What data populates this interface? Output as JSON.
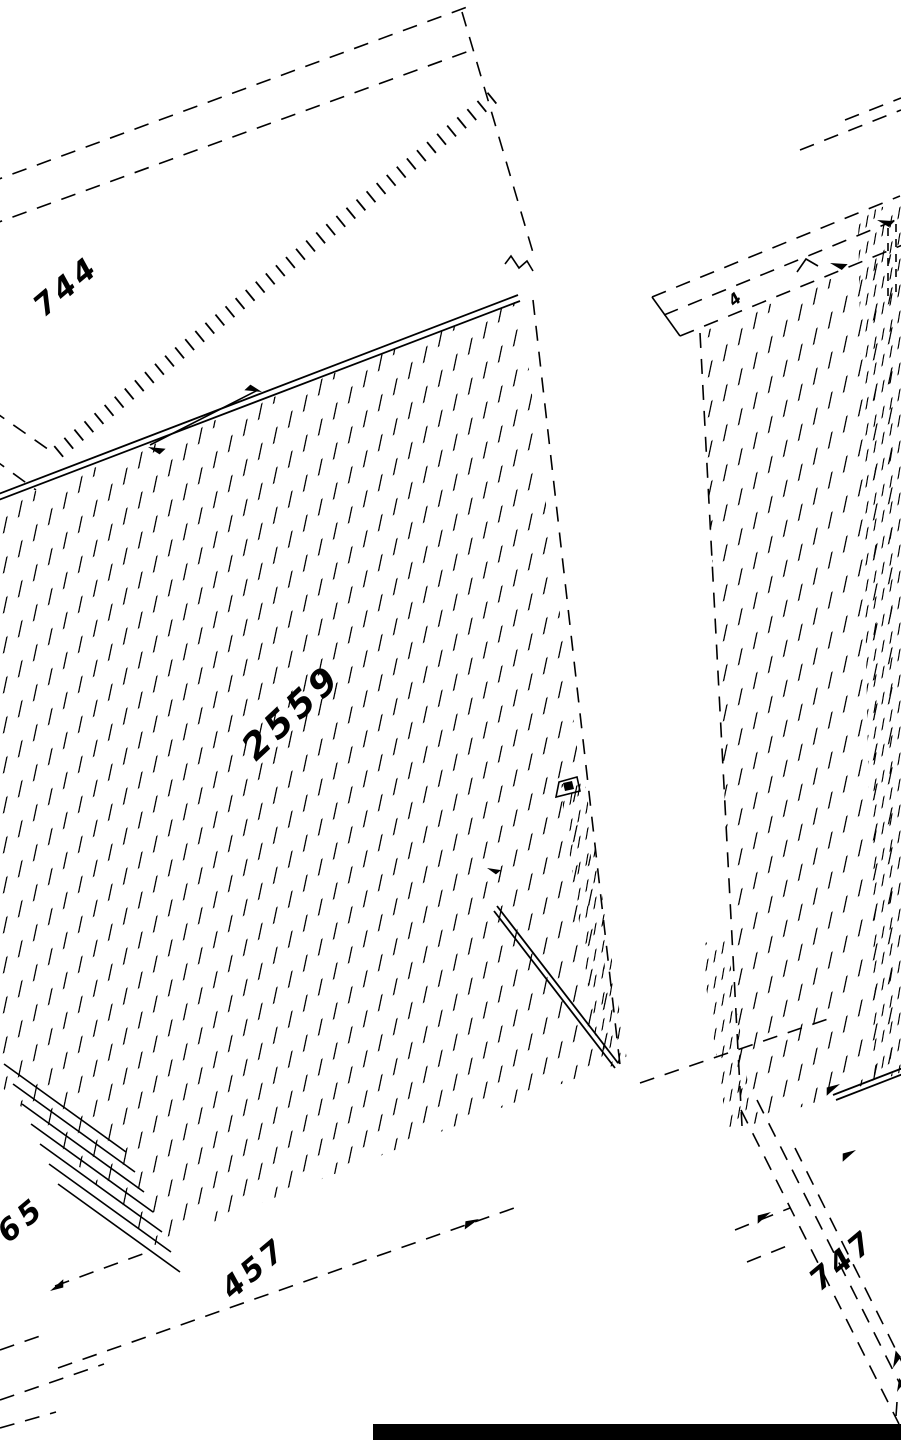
{
  "colors": {
    "ink": "#000000",
    "background": "#ffffff",
    "bottom_bar": "#000000"
  },
  "labels": {
    "top_panel_width": "744",
    "panel_height": "2559",
    "bottom_left_offset": "65",
    "bottom_depth": "457",
    "bottom_right_width": "747",
    "rail_mark": "4"
  }
}
